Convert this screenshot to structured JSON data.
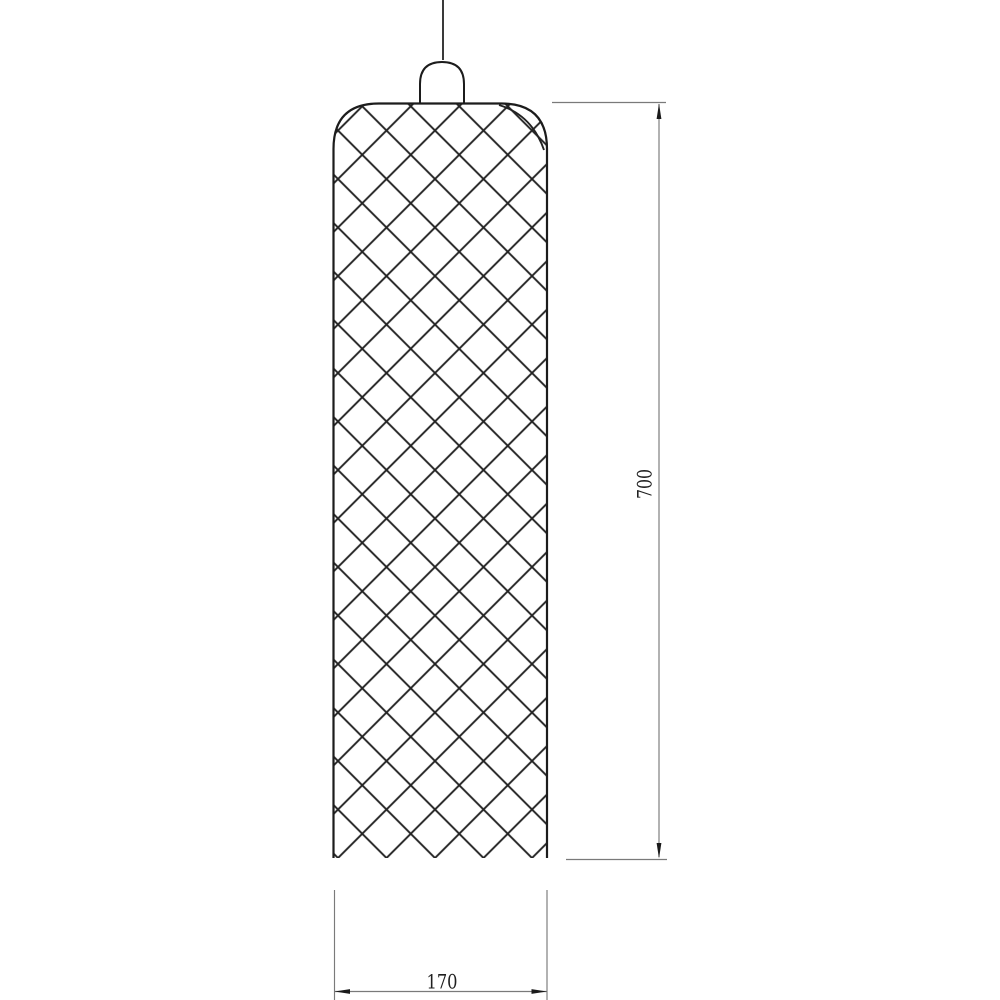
{
  "drawing": {
    "kind": "technical-line-drawing",
    "object": "cylindrical pendant lamp shade with diamond lattice pattern, hung from a cord with a small socket cap",
    "dimensions": {
      "height": {
        "label": "700",
        "orientation": "vertical",
        "side": "right"
      },
      "width": {
        "label": "170",
        "orientation": "horizontal",
        "side": "bottom"
      }
    },
    "colors": {
      "background": "#ffffff",
      "outline": "#1c1c1c",
      "hatch": "#222222",
      "dimension_line": "#7a7a7a",
      "arrow": "#1a1a1a",
      "dimension_text": "#1f1f1f"
    }
  }
}
